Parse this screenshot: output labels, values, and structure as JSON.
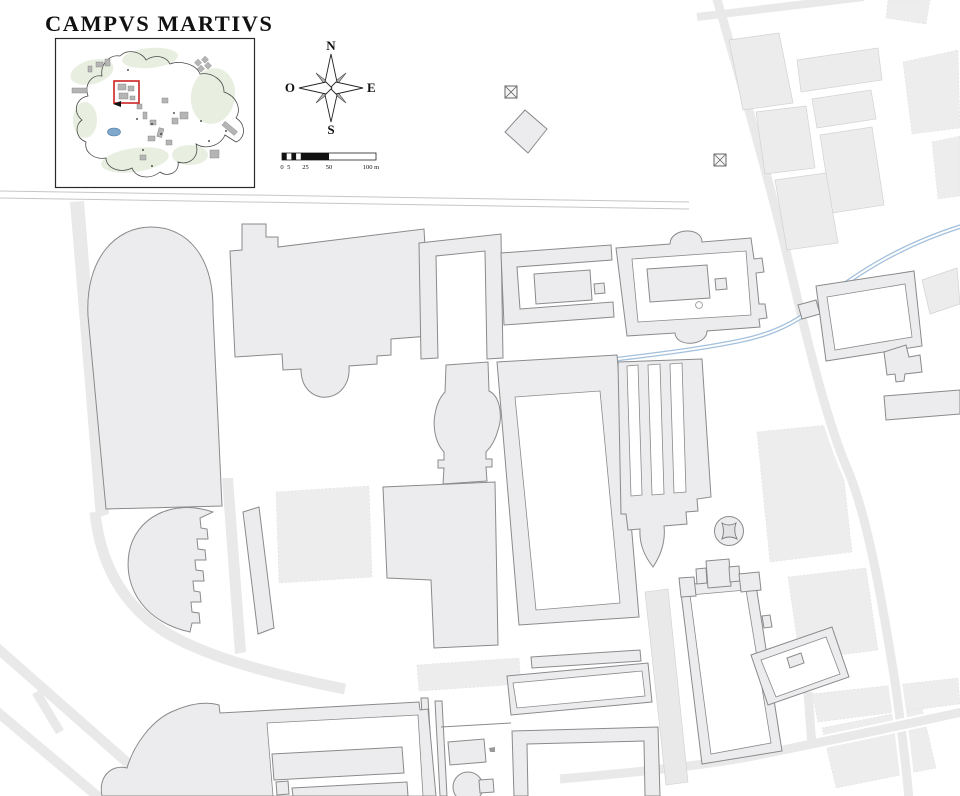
{
  "header": {
    "title": "CAMPVS MARTIVS"
  },
  "compass": {
    "north": "N",
    "east": "E",
    "south": "S",
    "west": "O"
  },
  "scale_bar": {
    "labels": [
      "0",
      "5",
      "25",
      "50",
      "100 m"
    ]
  },
  "palette": {
    "building-fill": "#ececee",
    "building-stroke": "#8a8a8a",
    "road-fill": "#e9e9e9",
    "fuzzy-fill": "#ededee",
    "aqueduct-blue": "#a3c0dd",
    "inset-green": "#e8efe0",
    "inset-water": "#7fa8cc",
    "highlight-red": "#cc2222",
    "text-color": "#111111"
  }
}
